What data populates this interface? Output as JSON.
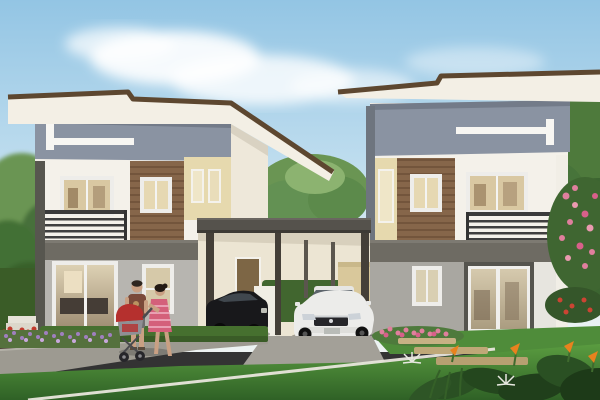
{
  "image": {
    "kind": "architectural exterior rendering",
    "subjects": [
      "two modern two-storey houses",
      "shared double carport",
      "black sedan",
      "white sedan",
      "man walking",
      "woman walking",
      "baby stroller",
      "front lawn",
      "garden flowers"
    ],
    "counts": {
      "houses": 2,
      "cars": 2,
      "people": 2,
      "strollers": 1
    }
  },
  "palette": {
    "sky_top": "#93c5e4",
    "sky_mid": "#bddcee",
    "sky_low": "#e8f1f4",
    "cloud": "#ffffff",
    "tree_light": "#8cb370",
    "tree_mid": "#6a9553",
    "tree_dark": "#46703a",
    "foliage_deep": "#2a5023",
    "roof_edge": "#5d4730",
    "roof_fascia": "#f3efe5",
    "wall_gray": "#8a93a2",
    "accent_white": "#f7f6f2",
    "wall_white": "#f4f1ea",
    "wood_panel": "#86664a",
    "wood_line": "#6e5138",
    "wing_beige": "#e6d9ae",
    "floor_band": "#6e6b63",
    "pillar_dark": "#57564f",
    "side_wall": "#eee8da",
    "ground_left": "#b7b5b0",
    "ground_right": "#a9a7a1",
    "ground_white": "#e7e5df",
    "window_frame": "#eeedea",
    "glass_warm": "#d9c8a2",
    "glass_pale": "#e6d8b2",
    "railing": "#3a3a3a",
    "carport_roof": "#55524c",
    "post": "#443f38",
    "interior_cream": "#ece5d3",
    "fence_beige": "#d9c89b",
    "door_wood": "#7d6645",
    "hedge": "#46702f",
    "hedge_dark": "#3a5c27",
    "lawn_light": "#5a9c40",
    "lawn_dark": "#2f6126",
    "mid_lawn": "#4f8c3a",
    "path": "#9d9a91",
    "driveway": "#a3a098",
    "curb_line": "#e9e6dd",
    "stone_tan": "#bfa878",
    "car_black": "#18181b",
    "car_black_glass": "#454c54",
    "car_white": "#ececea",
    "car_glass": "#5c646b",
    "chrome": "#cfd2d4",
    "flower_purple": "#a07fc0",
    "flower_purple_light": "#c9a8dd",
    "flower_pink": "#e07f9d",
    "flower_pink_deep": "#d8608a",
    "flower_red": "#c23b2e",
    "flower_orange": "#e8821e",
    "skin": "#c9a083",
    "hair_dark": "#231a14",
    "shirt_brown": "#7a4a3a",
    "shorts_gray": "#6f6f6f",
    "dress_pink": "#d4607a",
    "stroller_red": "#b5302e",
    "stroller_gray": "#8f8f94",
    "step_white": "#e6e2d8",
    "planter_dark": "#4f4337",
    "shadow": "#000000"
  }
}
